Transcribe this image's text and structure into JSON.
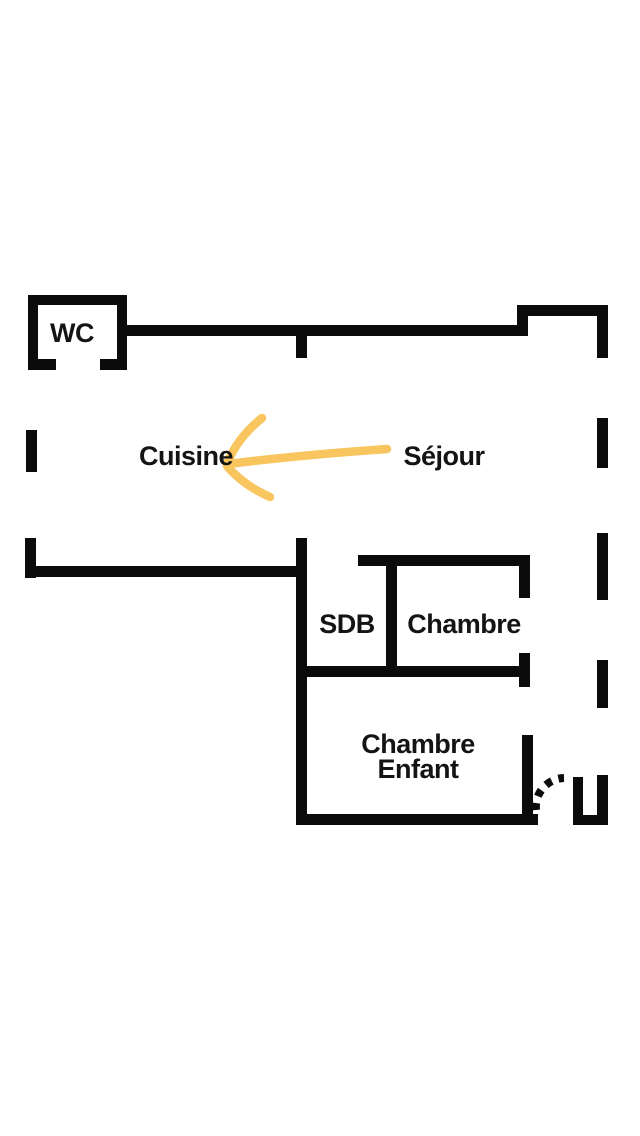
{
  "colors": {
    "wall": "#0b0b0b",
    "text": "#141414",
    "arrow": "#f8c55f",
    "background": "#ffffff"
  },
  "rooms": {
    "wc": "WC",
    "cuisine": "Cuisine",
    "sejour": "Séjour",
    "sdb": "SDB",
    "chambre": "Chambre",
    "chambre_enfant_line1": "Chambre",
    "chambre_enfant_line2": "Enfant"
  },
  "annotation": {
    "type": "hand-drawn-arrow",
    "points_from": "Séjour",
    "points_to": "Cuisine"
  }
}
